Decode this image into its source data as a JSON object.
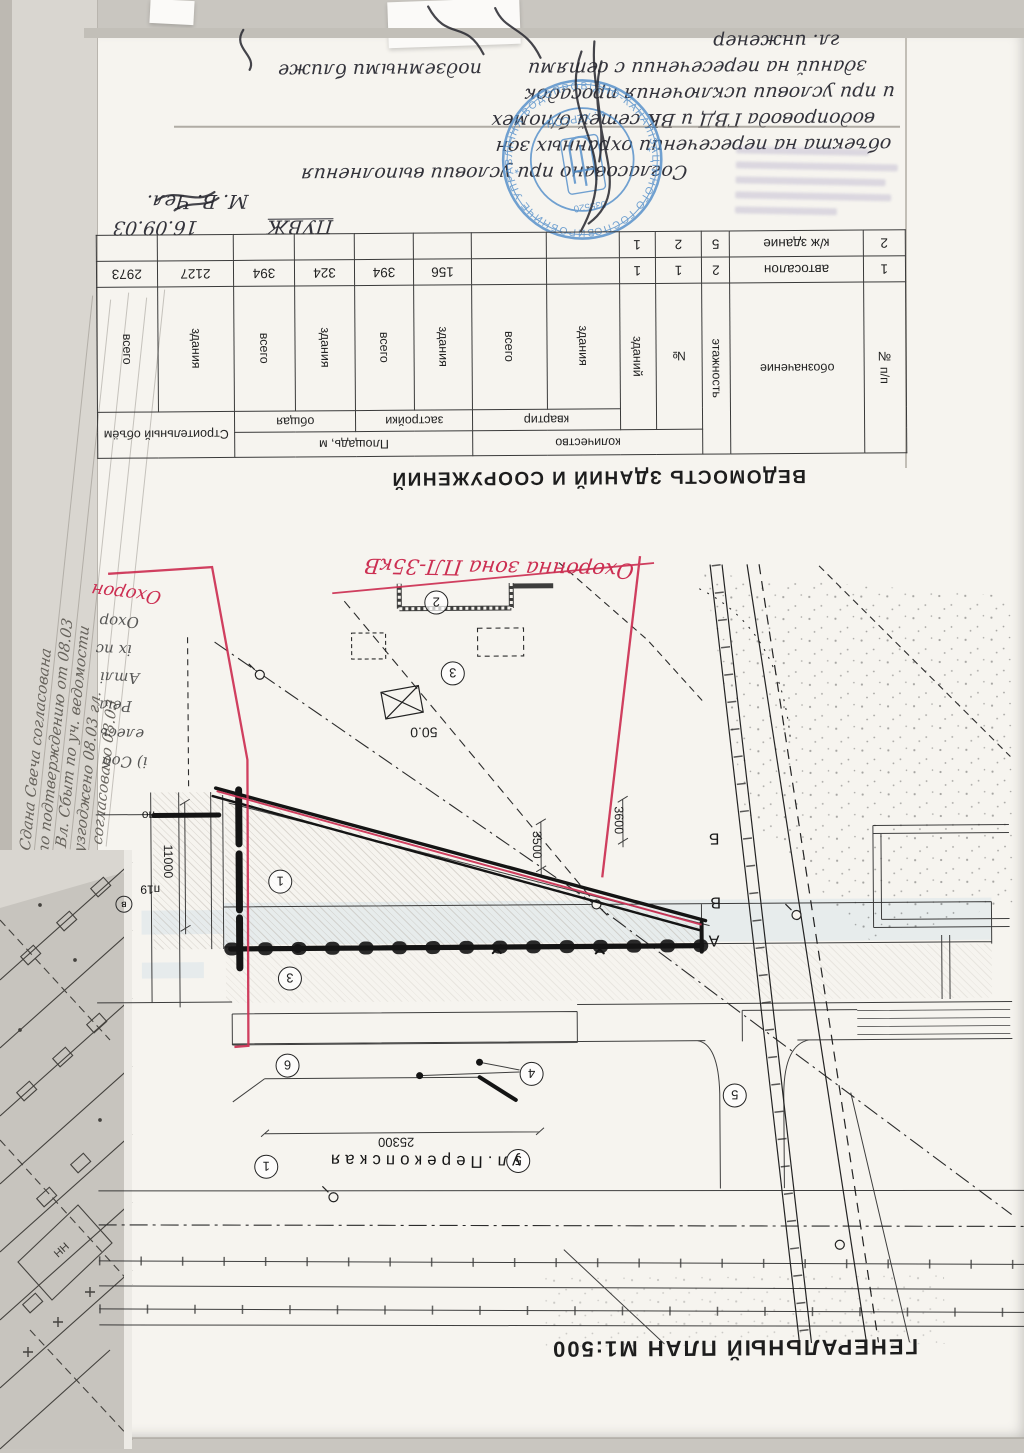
{
  "document": {
    "genplan_title": "ГЕНЕРАЛЬНЫЙ ПЛАН  М1:500",
    "vedomost_title": "ВЕДОМОСТЬ ЗДАНИЙ И СООРУЖЕНИЙ"
  },
  "handwriting": {
    "header": "ПУВЖ",
    "date": "16.09.03",
    "signer": "М. В. Чел.",
    "role": "гл. инженер",
    "lines": [
      "Согласовано при условии выполнения",
      "объекта на пересечении охранных зон",
      "водопровода ГВД и ВК сетей б/помех",
      "и при условии исключения просадок",
      "зданий на пересечении с сетями",
      "подземными ближе"
    ],
    "margin_lines": [
      "Сдана Свеча согласована",
      "по подтверждению от 08.03",
      "Вл. Сбыт по уч. ведомости",
      "узгоджено 08.03 гл.",
      "согласовано 08.03"
    ],
    "plan_notes": [
      "Охор",
      "іх пс",
      "Атлі",
      "Реіа",
      "елесь",
      "і) Соб"
    ]
  },
  "red_marks": {
    "zone_label": "Охоронна зона ПЛ-35кВ",
    "zone_label_partial": "Охорон"
  },
  "stamps": {
    "round": {
      "ring_text": "ВИРОБНИЧЕ УПРАВЛІННЯ ВОДОПРОВІДНО-КАНАЛІЗАЦІЙНОГО ГОСПОДАРСТВА",
      "inner_text": "м. ХЕРСОН",
      "number": "035520"
    }
  },
  "table": {
    "headers": {
      "npp": "№ п/п",
      "oboz": "обозначение",
      "etazh": "этажность",
      "kolvo": "количество",
      "nom": "№",
      "zdaniy": "зданий",
      "kvartir": "квартир",
      "zdaniya": "здания",
      "vsego": "всего",
      "ploshchad": "Площадь, м",
      "zastroyki": "застройки",
      "obshchaya": "общая",
      "obyom": "Строительный объём"
    },
    "rows": [
      {
        "cells": [
          "1",
          "автосалон",
          "2",
          "1",
          "1",
          "",
          "",
          "156",
          "394",
          "324",
          "394",
          "2127",
          "2973"
        ]
      },
      {
        "cells": [
          "2",
          "к/ж здание",
          "5",
          "2",
          "1",
          "",
          "",
          "",
          "",
          "",
          "",
          "",
          ""
        ]
      }
    ]
  },
  "plan": {
    "street": "ул.Перекопская",
    "dims": {
      "d3500": "3500",
      "d3600": "3600",
      "d11000": "11000",
      "d25300": "25300",
      "d50": "50.0"
    },
    "circles": [
      "2",
      "3",
      "1",
      "3",
      "6",
      "4",
      "5",
      "5",
      "1"
    ],
    "letters": [
      "Б",
      "В",
      "А"
    ],
    "small_labels": [
      "по",
      "п19",
      "в"
    ]
  },
  "underlay_map": {
    "label": "НН"
  }
}
